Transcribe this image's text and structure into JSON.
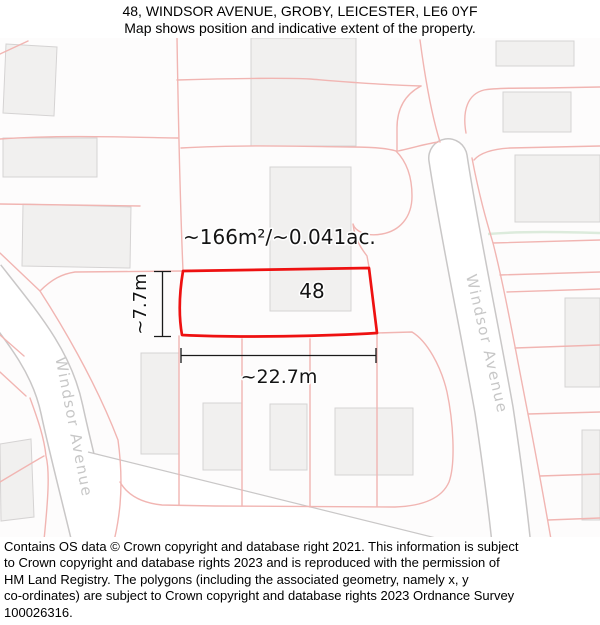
{
  "header": {
    "title": "48, WINDSOR AVENUE, GROBY, LEICESTER, LE6 0YF",
    "subtitle": "Map shows position and indicative extent of the property."
  },
  "map": {
    "plot": {
      "number": "48",
      "area_label": "~166m²/~0.041ac.",
      "width_label": "~22.7m",
      "depth_label": "~7.7m"
    },
    "streets": {
      "left": "Windsor Avenue",
      "right": "Windsor Avenue"
    },
    "colors": {
      "plot_outline": "#ee1111",
      "parcel_line": "#f1b5b2",
      "building_fill": "#f1f0ef",
      "building_stroke": "#d5d3d3",
      "road_casing": "#c9c7c7",
      "road_fill": "#ffffff",
      "street_label": "#c7c7c7",
      "hedge_line": "#dcebdc",
      "map_background": "#fdfcfc"
    }
  },
  "footer": {
    "lines": [
      "Contains OS data © Crown copyright and database right 2021. This information is subject",
      "to Crown copyright and database rights 2023 and is reproduced with the permission of",
      "HM Land Registry. The polygons (including the associated geometry, namely x, y",
      "co-ordinates) are subject to Crown copyright and database rights 2023 Ordnance Survey",
      "100026316."
    ]
  }
}
